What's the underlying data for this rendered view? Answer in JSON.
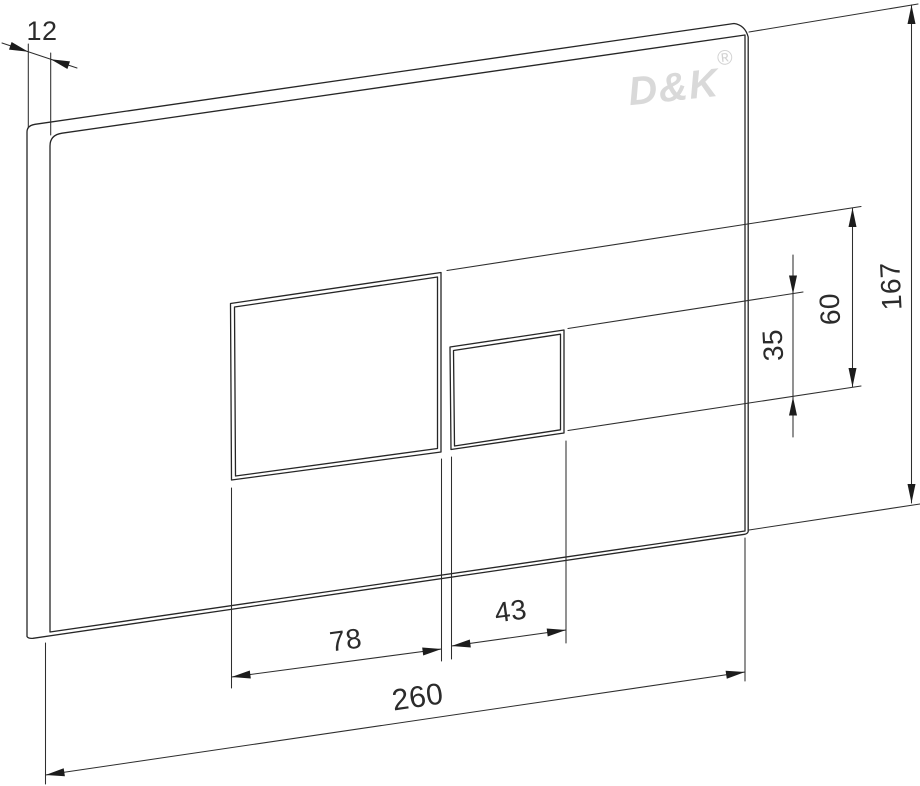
{
  "drawing": {
    "title": "Flush plate technical drawing",
    "brand": "D&K",
    "registered_mark": "®",
    "dims": {
      "thickness": {
        "label": "12",
        "value": 12
      },
      "plate_height": {
        "label": "167",
        "value": 167
      },
      "large_button_height": {
        "label": "60",
        "value": 60
      },
      "small_button_height": {
        "label": "35",
        "value": 35
      },
      "large_button_width": {
        "label": "78",
        "value": 78
      },
      "small_button_width": {
        "label": "43",
        "value": 43
      },
      "plate_width": {
        "label": "260",
        "value": 260
      }
    },
    "colors": {
      "line": "#262626",
      "logo": "#d9d9d9",
      "background": "#ffffff"
    }
  }
}
